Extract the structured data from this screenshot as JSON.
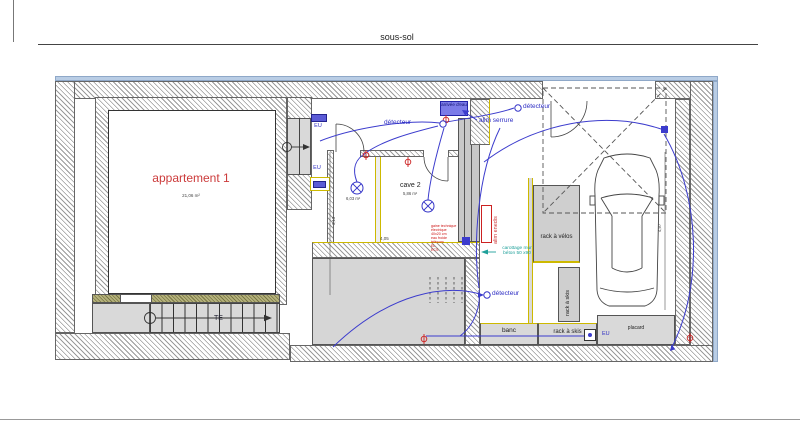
{
  "title": "sous-sol",
  "rooms": {
    "appartement1": {
      "name": "appartement 1",
      "area": "21,06 m²"
    },
    "cave1": {
      "area": "6,03 m²"
    },
    "cave2": {
      "name": "cave 2",
      "area": "5,86 m²"
    }
  },
  "annotations": {
    "detector1": "détecteur",
    "detector2": "détecteur",
    "detector3": "détecteur",
    "alim_serrure": "alim serrure",
    "arrivee_eau": "arrivée d'eau",
    "alim_enedis": "alim enedis",
    "carottage": "carottage mur béton 50 x90",
    "gaine_lines": [
      "gaine technique",
      "électrique",
      "40x20 cm",
      "eau froide",
      "télécom",
      "EL",
      "ECS"
    ],
    "eu1": "EU",
    "eu2": "EU",
    "eu3": "EU",
    "te": "TE"
  },
  "furniture": {
    "banc": "banc",
    "rack_velos": "rack à vélos",
    "rack_skis_v": "rack à skis",
    "rack_skis_h": "rack à skis",
    "placard": "placard"
  },
  "dimensions": {
    "caves_width": "4,05",
    "corridor_height": "3,13",
    "garage_depth": "4,97"
  },
  "colors": {
    "wiring_blue": "#3c3ccd",
    "label_red": "#cc3b3b",
    "note_teal": "#1fa09a",
    "wood_yellow": "#cdb900",
    "insulation_blue": "#b9cde5",
    "wall_hatch_gray": "#9a9a9a"
  }
}
